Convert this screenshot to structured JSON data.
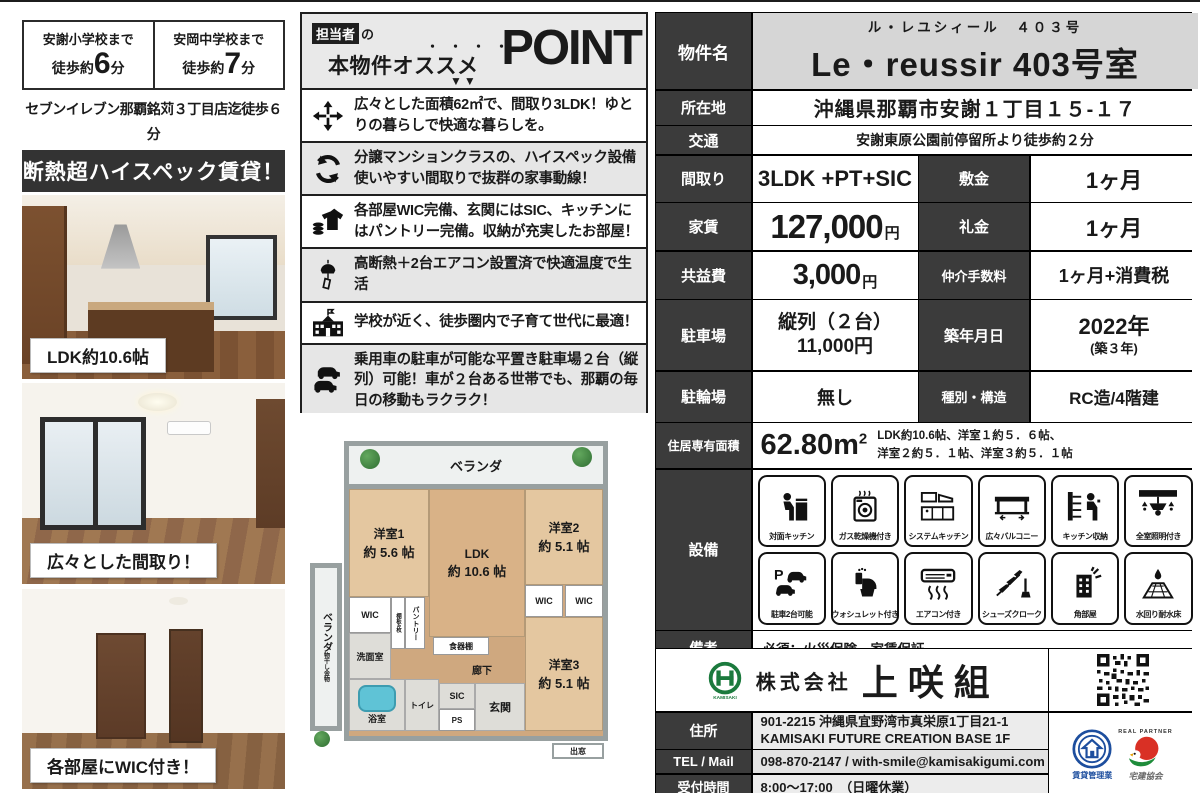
{
  "access": {
    "school1": {
      "name": "安謝小学校まで",
      "prefix": "徒歩約",
      "minutes": "6",
      "suffix": "分"
    },
    "school2": {
      "name": "安岡中学校まで",
      "prefix": "徒歩約",
      "minutes": "7",
      "suffix": "分"
    },
    "store_line1": "セブンイレブン那覇銘苅３丁目店迄徒歩６分",
    "store_line2": "マックスバリュ安謝店徒歩5分！"
  },
  "banner": {
    "text": "断熱超ハイスペック賃貸！"
  },
  "photos": [
    {
      "caption": "LDK約10.6帖"
    },
    {
      "caption": "広々とした間取り！"
    },
    {
      "caption": "各部屋にWIC付き！"
    }
  ],
  "points": {
    "header": {
      "tag": "担当者",
      "particle": "の",
      "line_a": "本物件",
      "line_b": "オススメ",
      "dots": "・・・・",
      "big": "POINT",
      "arrows": "▼▼"
    },
    "items": [
      {
        "icon": "expand-arrows-icon",
        "text": "広々とした面積62㎡で、間取り3LDK！ゆとりの暮らしで快適な暮らしを。"
      },
      {
        "icon": "cycle-icon",
        "text": "分譲マンションクラスの、ハイスペック設備使いやすい間取りで抜群の家事動線！"
      },
      {
        "icon": "storage-clothes-icon",
        "text": "各部屋WIC完備、玄関にはSIC、キッチンにはパントリー完備。収納が充実したお部屋！"
      },
      {
        "icon": "windchime-icon",
        "text": "高断熱＋2台エアコン設置済で快適温度で生活"
      },
      {
        "icon": "school-icon",
        "text": "学校が近く、徒歩圏内で子育て世代に最適！"
      },
      {
        "icon": "two-cars-icon",
        "text": "乗用車の駐車が可能な平置き駐車場２台（縦列）可能！車が２台ある世帯でも、那覇の毎日の移動もラクラク！"
      }
    ]
  },
  "floorplan": {
    "veranda_top": "ベランダ",
    "veranda_left": "ベランダ",
    "laundry": "物干し金物",
    "room1": "洋室1",
    "room1_size": "約 5.6 帖",
    "ldk": "LDK",
    "ldk_size": "約 10.6 帖",
    "room2": "洋室2",
    "room2_size": "約 5.1 帖",
    "room3": "洋室3",
    "room3_size": "約 5.1 帖",
    "wic": "WIC",
    "pantry": "パントリー",
    "shelf4": "棚板4枚",
    "dish_shelf": "食器棚",
    "washroom": "洗面室",
    "bath": "浴室",
    "toilet": "トイレ",
    "sic": "SIC",
    "entrance": "玄関",
    "ps": "PS",
    "hall": "廊下",
    "bay_window": "出窓"
  },
  "table": {
    "name": {
      "label": "物件名",
      "kana": "ル・レユシィール　４０３号",
      "value": "Le・reussir 403号室"
    },
    "location": {
      "label": "所在地",
      "value": "沖縄県那覇市安謝１丁目１５-１７"
    },
    "transport": {
      "label": "交通",
      "value": "安謝東原公園前停留所より徒歩約２分"
    },
    "layout": {
      "label": "間取り",
      "value": "3LDK +PT+SIC"
    },
    "deposit": {
      "label": "敷金",
      "value": "1ヶ月"
    },
    "rent": {
      "label": "家賃",
      "value": "127,000",
      "unit": "円"
    },
    "key_money": {
      "label": "礼金",
      "value": "1ヶ月"
    },
    "common_fee": {
      "label": "共益費",
      "value": "3,000",
      "unit": "円"
    },
    "agency_fee": {
      "label": "仲介手数料",
      "value": "1ヶ月+消費税"
    },
    "parking": {
      "label": "駐車場",
      "line1": "縦列（２台）",
      "line2": "11,000円"
    },
    "built": {
      "label": "築年月日",
      "line1": "2022年",
      "line2": "(築３年)"
    },
    "bicycle": {
      "label": "駐輪場",
      "value": "無し"
    },
    "structure": {
      "label": "種別・構造",
      "value": "RC造/4階建"
    },
    "area": {
      "label": "住居専有面積",
      "value": "62.80m",
      "sup": "2",
      "desc1": "LDK約10.6帖、洋室１約５．６帖、",
      "desc2": "洋室２約５．１帖、洋室３約５．１帖"
    },
    "equipment": {
      "label": "設備",
      "items": [
        {
          "icon": "counter-kitchen-icon",
          "label": "対面キッチン"
        },
        {
          "icon": "gas-dryer-icon",
          "label": "ガス乾燥機付き"
        },
        {
          "icon": "system-kitchen-icon",
          "label": "システムキッチン"
        },
        {
          "icon": "balcony-icon",
          "label": "広々バルコニー"
        },
        {
          "icon": "kitchen-storage-icon",
          "label": "キッチン収納"
        },
        {
          "icon": "lighting-icon",
          "label": "全室照明付き"
        },
        {
          "icon": "parking-two-icon",
          "label": "駐車2台可能"
        },
        {
          "icon": "washlet-icon",
          "label": "ウォシュレット付き"
        },
        {
          "icon": "aircon-icon",
          "label": "エアコン付き"
        },
        {
          "icon": "shoe-closet-icon",
          "label": "シューズクローク"
        },
        {
          "icon": "corner-room-icon",
          "label": "角部屋"
        },
        {
          "icon": "waterproof-floor-icon",
          "label": "水回り耐水床"
        }
      ]
    },
    "notes": {
      "label": "備考",
      "value": "必須：火災保険、家賃保証"
    }
  },
  "company": {
    "prefix": "株式会社",
    "name": "上咲組",
    "address": {
      "label": "住所",
      "line1": "901-2215 沖縄県宜野湾市真栄原1丁目21-1",
      "line2": "KAMISAKI FUTURE CREATION BASE 1F"
    },
    "tel": {
      "label": "TEL / Mail",
      "value": "098-870-2147 / with-smile@kamisakigumi.com"
    },
    "hours": {
      "label": "受付時間",
      "value": "8:00～17:00　（日曜休業）"
    },
    "badge1": "賃貸管理業",
    "badge2": "宅建協会",
    "badge2_top": "REAL PARTNER"
  },
  "colors": {
    "label_bg": "#3b3b3b",
    "banner_bg": "#333333",
    "name_bg": "#d6d6d6",
    "logo_green": "#1b7a3d",
    "badge_blue": "#1d4e9e",
    "badge_red": "#d93025"
  }
}
